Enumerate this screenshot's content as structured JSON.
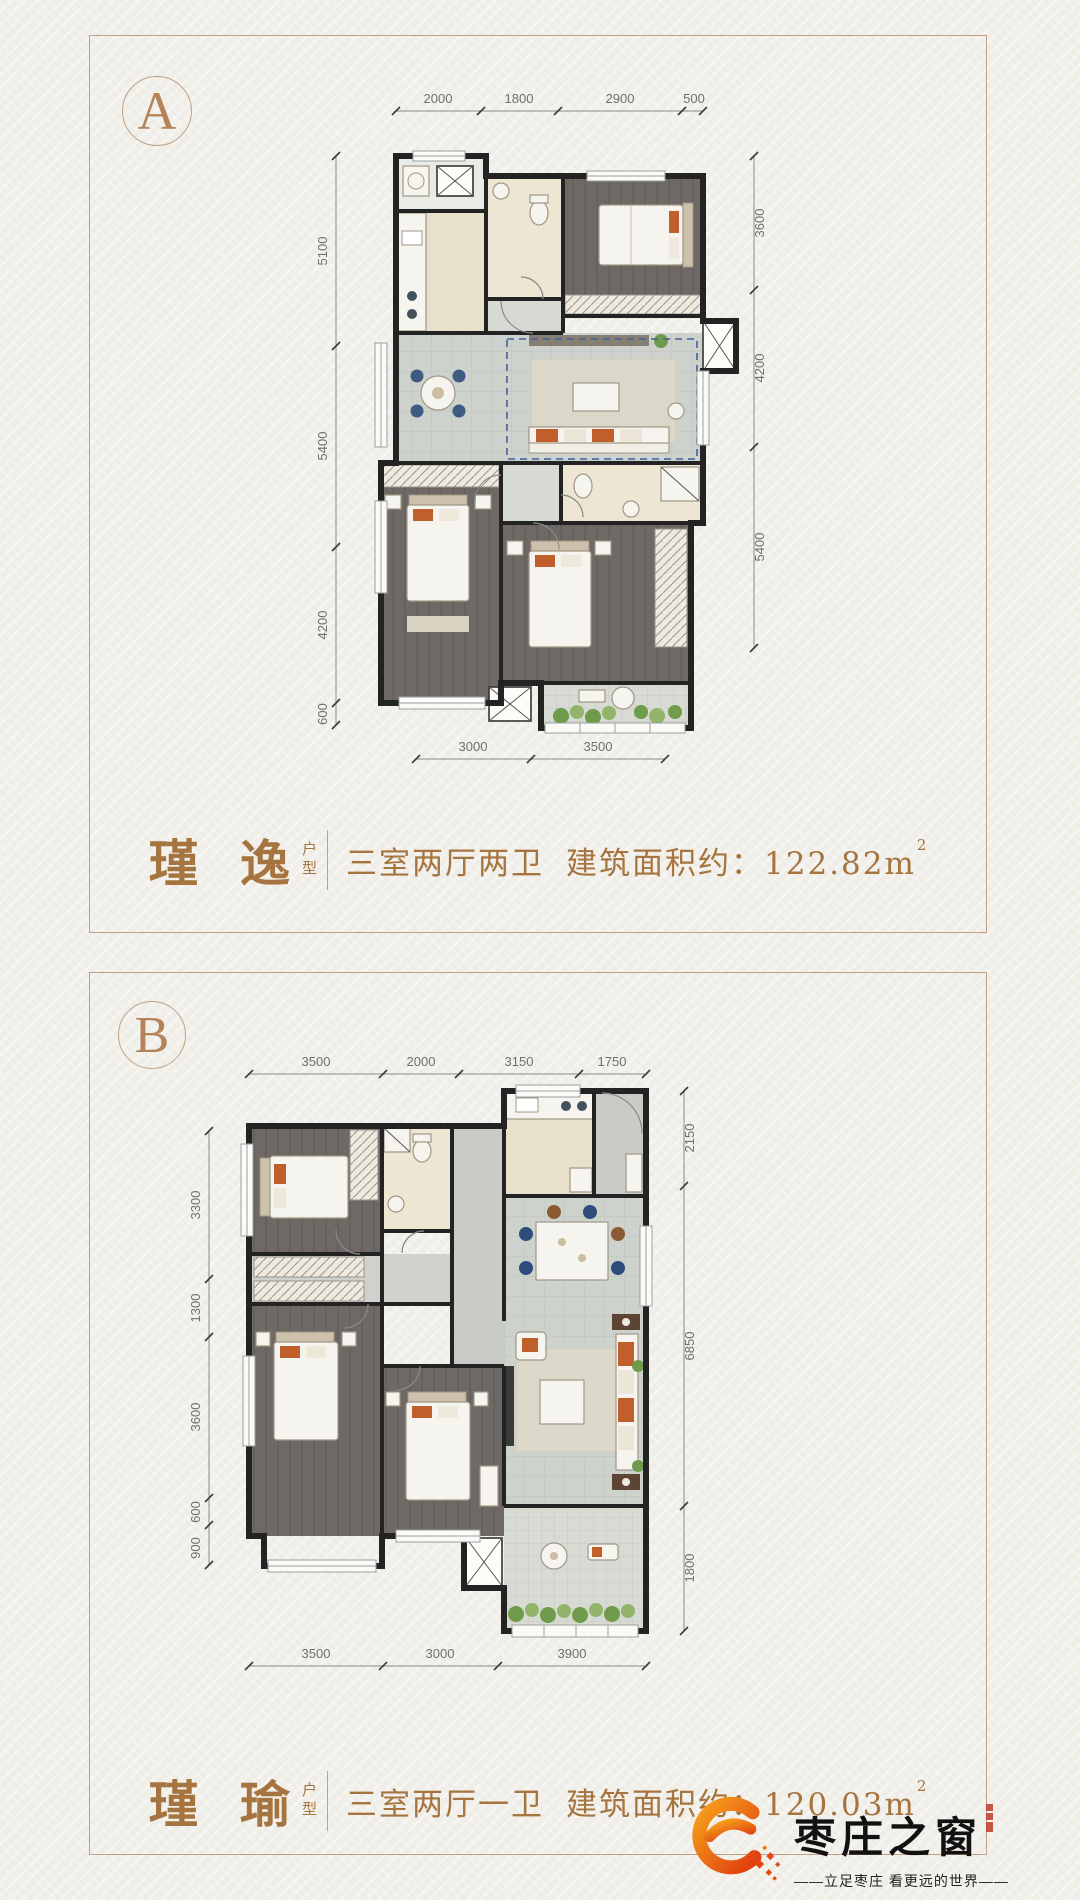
{
  "page": {
    "background": "#f1efe9",
    "frame_color": "#c2a183"
  },
  "plans": [
    {
      "badge": "A",
      "name": "瑾 逸",
      "type_chars": [
        "户",
        "型"
      ],
      "rooms": "三室两厅两卫",
      "area_prefix": "建筑面积约：",
      "area_value": "122.82m",
      "area_sup": "2",
      "dims_top": [
        "2000",
        "1800",
        "2900",
        "500"
      ],
      "dims_left": [
        "5100",
        "5400",
        "4200",
        "600"
      ],
      "dims_right": [
        "3600",
        "4200",
        "5400"
      ],
      "dims_bottom": [
        "3000",
        "3500"
      ]
    },
    {
      "badge": "B",
      "name": "瑾 瑜",
      "type_chars": [
        "户",
        "型"
      ],
      "rooms": "三室两厅一卫",
      "area_prefix": "建筑面积约：",
      "area_value": "120.03m",
      "area_sup": "2",
      "dims_top": [
        "3500",
        "2000",
        "3150",
        "1750"
      ],
      "dims_left": [
        "3300",
        "1300",
        "3600",
        "600",
        "900"
      ],
      "dims_right": [
        "2150",
        "6850",
        "1800"
      ],
      "dims_bottom": [
        "3500",
        "3000",
        "3900"
      ]
    }
  ],
  "logo": {
    "brand": "枣庄之窗",
    "tagline": "——立足枣庄  看更远的世界——",
    "accent_start": "#f6a21c",
    "accent_end": "#e03c0e"
  }
}
